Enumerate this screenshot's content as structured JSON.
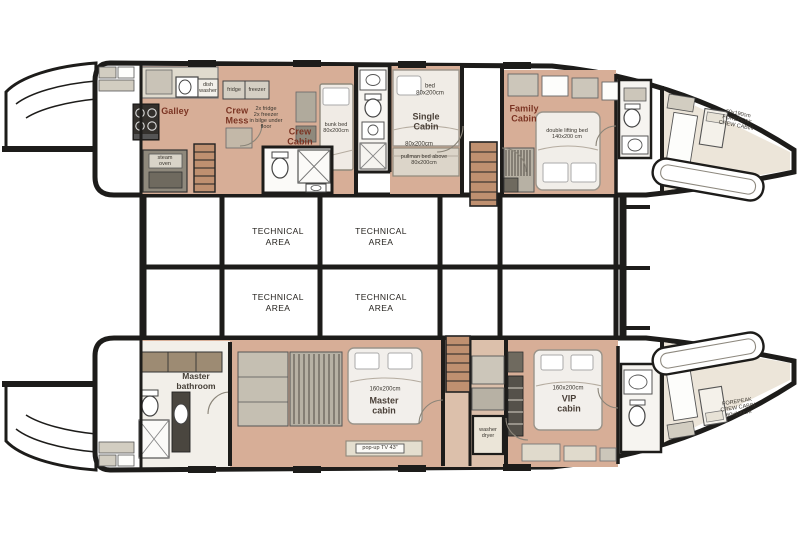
{
  "rooms": {
    "galley": "Galley",
    "crew_mess": "Crew\nMess",
    "crew_cabin": "Crew\nCabin",
    "single_cabin": "Single\nCabin",
    "family_cabin": "Family\nCabin",
    "master_bathroom": "Master\nbathroom",
    "master_cabin": "Master\ncabin",
    "vip_cabin": "VIP\ncabin",
    "technical_area": "TECHNICAL\nAREA",
    "forepeak_top": "60x190cm\nFOREPEAK\nCREW CABIN",
    "forepeak_bottom": "FOREPEAK\nCREW CABIN\n60x190cm"
  },
  "annotations": {
    "fridge": "fridge",
    "freezer": "freezer",
    "fridge_note": "2x fridge\n2x freezer\nin bilge under\nfloor",
    "dish_washer": "dish\nwasher",
    "steam_oven": "steam\noven",
    "crew_bed": "bunk bed\n80x200cm",
    "single_bed": "bed\n80x200cm",
    "single_bottom_size": "80x200cm",
    "pullman_note": "pullman bed above\n80x200cm",
    "family_bed": "double lifting bed\n140x200 cm",
    "master_bed_size": "160x200cm",
    "vip_bed_size": "160x200cm",
    "popup_tv": "pop-up TV 43\"",
    "washer_dryer": "washer\ndryer"
  },
  "colors": {
    "wall": "#1d1c1a",
    "wood_floor": "#d7ae97",
    "stair_wood": "#bf9070",
    "room_label_accent": "#7b3423",
    "annotation_text": "#3a362f"
  }
}
